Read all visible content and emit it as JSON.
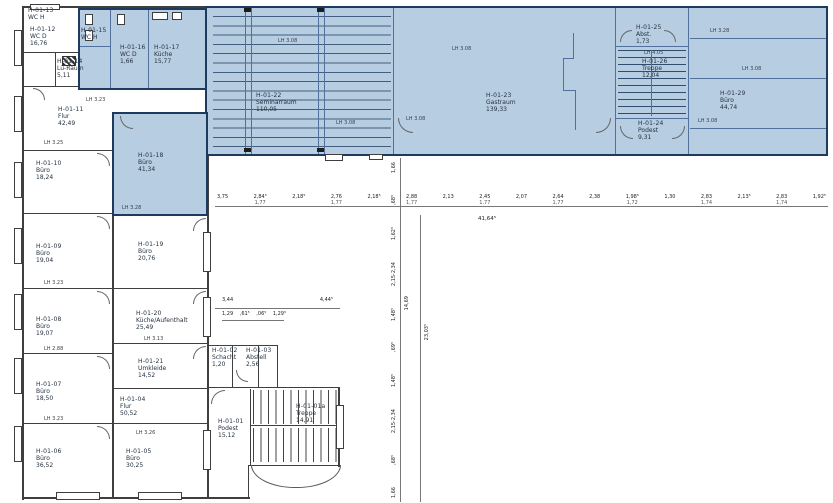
{
  "drawing_title": "Grundriss 1. OG Haus H",
  "colors": {
    "highlight_fill": "#b7cde1",
    "highlight_border": "#1d3b5e",
    "wall": "#3f3f3f"
  },
  "rooms": {
    "r01": {
      "id": "H-01-01",
      "name": "Podest",
      "area": "15,12"
    },
    "r01a": {
      "id": "H-01-01a",
      "name": "Treppe",
      "area": "14,91"
    },
    "r02": {
      "id": "H-01-02",
      "name": "Schacht",
      "area": "1,20"
    },
    "r03": {
      "id": "H-01-03",
      "name": "Abstell",
      "area": "2,56"
    },
    "r04": {
      "id": "H-01-04",
      "name": "Flur",
      "area": "50,52"
    },
    "r05": {
      "id": "H-01-05",
      "name": "Büro",
      "area": "30,25"
    },
    "r06": {
      "id": "H-01-06",
      "name": "Büro",
      "area": "36,52"
    },
    "r07": {
      "id": "H-01-07",
      "name": "Büro",
      "area": "18,50"
    },
    "r08": {
      "id": "H-01-08",
      "name": "Büro",
      "area": "19,07"
    },
    "r09": {
      "id": "H-01-09",
      "name": "Büro",
      "area": "19,04"
    },
    "r10": {
      "id": "H-01-10",
      "name": "Büro",
      "area": "18,24"
    },
    "r11": {
      "id": "H-01-11",
      "name": "Flur",
      "area": "42,49"
    },
    "r12": {
      "id": "H-01-12",
      "name": "WC D",
      "area": "16,76"
    },
    "r13": {
      "id": "H-01-13",
      "name": "WC H",
      "area": ""
    },
    "r14": {
      "id": "H-01-14",
      "name": "Lü-Raum",
      "area": "5,11"
    },
    "r15": {
      "id": "H-01-15",
      "name": "WC H",
      "area": ""
    },
    "r16": {
      "id": "H-01-16",
      "name": "WC D",
      "area": "1,66"
    },
    "r17": {
      "id": "H-01-17",
      "name": "Küche",
      "area": "15,77"
    },
    "r18": {
      "id": "H-01-18",
      "name": "Büro",
      "area": "41,34"
    },
    "r19": {
      "id": "H-01-19",
      "name": "Büro",
      "area": "20,76"
    },
    "r20": {
      "id": "H-01-20",
      "name": "Küche/Aufenthalt",
      "area": "25,49"
    },
    "r21": {
      "id": "H-01-21",
      "name": "Umkleide",
      "area": "14,52"
    },
    "r22": {
      "id": "H-01-22",
      "name": "Seminarraum",
      "area": "110,05"
    },
    "r23": {
      "id": "H-01-23",
      "name": "Gastraum",
      "area": "139,33"
    },
    "r24": {
      "id": "H-01-24",
      "name": "Podest",
      "area": "9,31"
    },
    "r25": {
      "id": "H-01-25",
      "name": "Abst.",
      "area": "1,73"
    },
    "r26": {
      "id": "H-01-26",
      "name": "Treppe",
      "area": "12,04"
    },
    "r29": {
      "id": "H-01-29",
      "name": "Büro",
      "area": "44,74"
    }
  },
  "dims": {
    "top_chain": [
      {
        "a": "3,75",
        "b": ""
      },
      {
        "a": "2,84⁵",
        "b": "1,77"
      },
      {
        "a": "2,18⁵",
        "b": ""
      },
      {
        "a": "2,76",
        "b": "1,77"
      },
      {
        "a": "2,18⁵",
        "b": ""
      },
      {
        "a": "2,88",
        "b": "1,77"
      },
      {
        "a": "2,13",
        "b": ""
      },
      {
        "a": "2,45",
        "b": "1,77"
      },
      {
        "a": "2,07",
        "b": ""
      },
      {
        "a": "2,64",
        "b": "1,77"
      },
      {
        "a": "2,38",
        "b": ""
      },
      {
        "a": "1,98⁵",
        "b": "1,72"
      },
      {
        "a": "1,30",
        "b": ""
      },
      {
        "a": "2,83",
        "b": "1,74"
      },
      {
        "a": "2,13⁵",
        "b": ""
      },
      {
        "a": "2,83",
        "b": "1,74"
      },
      {
        "a": "1,92⁵",
        "b": ""
      }
    ],
    "top_total": "41,64⁵",
    "mid_chain": [
      "3,44",
      "4,44⁵"
    ],
    "mid_sub_chain": [
      "1,29",
      ",61⁵",
      ",06⁵",
      "1,29⁵"
    ],
    "v_chain": [
      "1,66",
      ",68⁵",
      "1,62⁵",
      "2,15-2,34",
      "1,48⁵",
      ",69⁵",
      "1,48⁵",
      "2,15-2,34",
      ",68⁵",
      "1,66"
    ],
    "v_total_1": "14,69",
    "v_total_2": "23,03⁵"
  },
  "lh_labels": [
    "LH 3.23",
    "LH 3.25",
    "LH 3.28",
    "LH 3.08",
    "LH 3.08",
    "LH 3.08",
    "LH 3.28",
    "LH 3.08",
    "LH 3.08",
    "LH 3.13",
    "LH 3.23",
    "LH 4.05",
    "LH 2.88",
    "LH 3.23",
    "LH 3.26",
    "LH 3.08"
  ]
}
